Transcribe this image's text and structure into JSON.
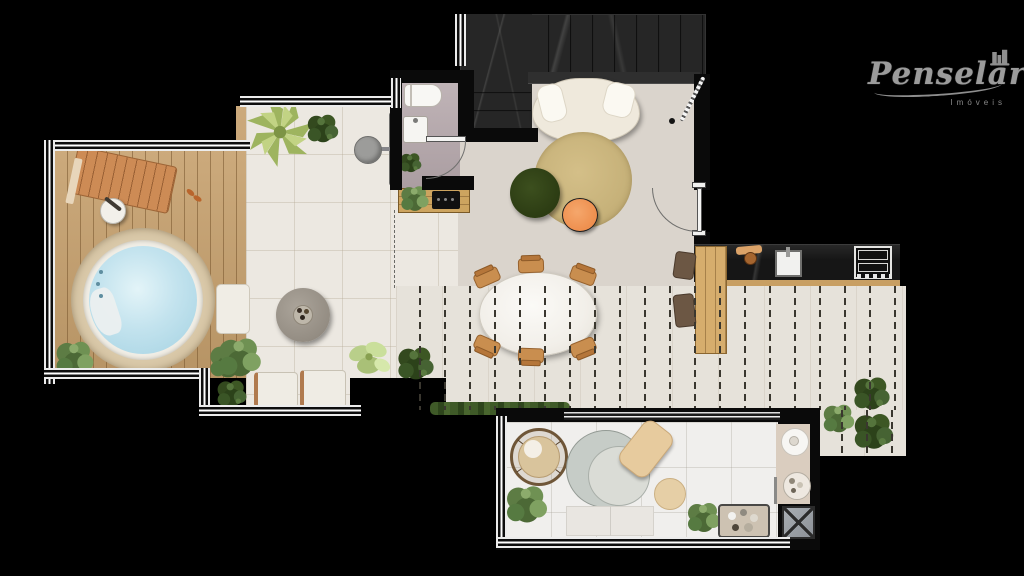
{
  "brand": {
    "name": "Penselar",
    "tagline": "Imóveis"
  },
  "palette": {
    "background": "#000000",
    "deck_wood": "#c6a06d",
    "hot_tub_water": "#bfe0ec",
    "patio_tile": "#ece8e1",
    "living_floor": "#dad4cc",
    "stairs_marble": "#262626",
    "kitchen_counter": "#161616",
    "rug_beige": "#c9b47d",
    "ottoman_green": "#2e3e16",
    "accent_orange": "#ef9355",
    "plant_green": "#3d5724",
    "brand_gray": "#9b9b9b"
  }
}
